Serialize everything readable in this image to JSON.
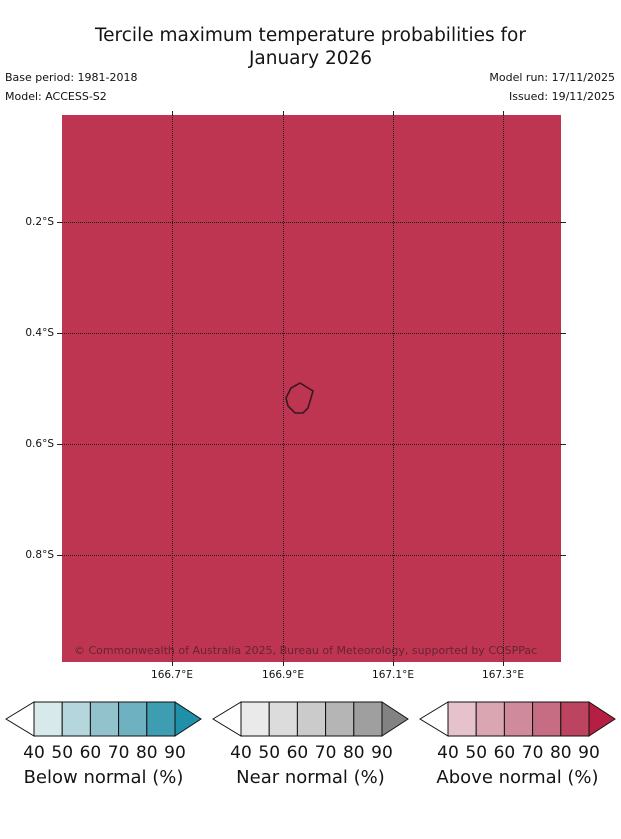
{
  "title": {
    "line1": "Tercile maximum temperature probabilities for",
    "line2": "January 2026"
  },
  "meta": {
    "base_period": "Base period: 1981-2018",
    "model": "Model: ACCESS-S2",
    "model_run": "Model run: 17/11/2025",
    "issued": "Issued: 19/11/2025"
  },
  "map": {
    "fill_color": "#bd3551",
    "island_outline_color": "#3a161f",
    "copyright": "© Commonwealth of Australia 2025, Bureau of Meteorology, supported by COSPPac"
  },
  "axes": {
    "x_tick_labels": [
      "166.7°E",
      "166.9°E",
      "167.1°E",
      "167.3°E"
    ],
    "y_tick_labels": [
      "0.2°S",
      "0.4°S",
      "0.6°S",
      "0.8°S"
    ]
  },
  "legends": [
    {
      "title": "Below normal (%)",
      "ticks": [
        "40",
        "50",
        "60",
        "70",
        "80",
        "90"
      ],
      "colors": [
        "#d8e9ec",
        "#b5d6dd",
        "#92c3cd",
        "#6eb2c1",
        "#3e9db1"
      ],
      "left_arrow_color": "#ffffff",
      "right_arrow_color": "#2090a8"
    },
    {
      "title": "Near normal (%)",
      "ticks": [
        "40",
        "50",
        "60",
        "70",
        "80",
        "90"
      ],
      "colors": [
        "#eaeaea",
        "#dcdcdc",
        "#cbcbcb",
        "#b5b5b5",
        "#9f9f9f"
      ],
      "left_arrow_color": "#ffffff",
      "right_arrow_color": "#828282"
    },
    {
      "title": "Above normal (%)",
      "ticks": [
        "40",
        "50",
        "60",
        "70",
        "80",
        "90"
      ],
      "colors": [
        "#e6c3cc",
        "#daa6b2",
        "#cf8a9b",
        "#c66d83",
        "#bc4461"
      ],
      "left_arrow_color": "#ffffff",
      "right_arrow_color": "#b51f44"
    }
  ],
  "chart_data": {
    "type": "heatmap",
    "title": "Tercile maximum temperature probabilities for January 2026",
    "x_ticks": [
      "166.7°E",
      "166.9°E",
      "167.1°E",
      "167.3°E"
    ],
    "y_ticks": [
      "0.2°S",
      "0.4°S",
      "0.6°S",
      "0.8°S"
    ],
    "x_range": "166.5°E to 167.4°E",
    "y_range": "0.0°S to 1.0°S",
    "grid": "dotted lat/lon graticule every 0.2°",
    "uniform_field_value": "entire region shaded in the Above normal 80-90% class color",
    "legend_scales": [
      {
        "name": "Below normal (%)",
        "breaks": [
          40,
          50,
          60,
          70,
          80,
          90
        ]
      },
      {
        "name": "Near normal (%)",
        "breaks": [
          40,
          50,
          60,
          70,
          80,
          90
        ]
      },
      {
        "name": "Above normal (%)",
        "breaks": [
          40,
          50,
          60,
          70,
          80,
          90
        ]
      }
    ],
    "legend_position": "bottom, three horizontal arrow colorbars"
  }
}
